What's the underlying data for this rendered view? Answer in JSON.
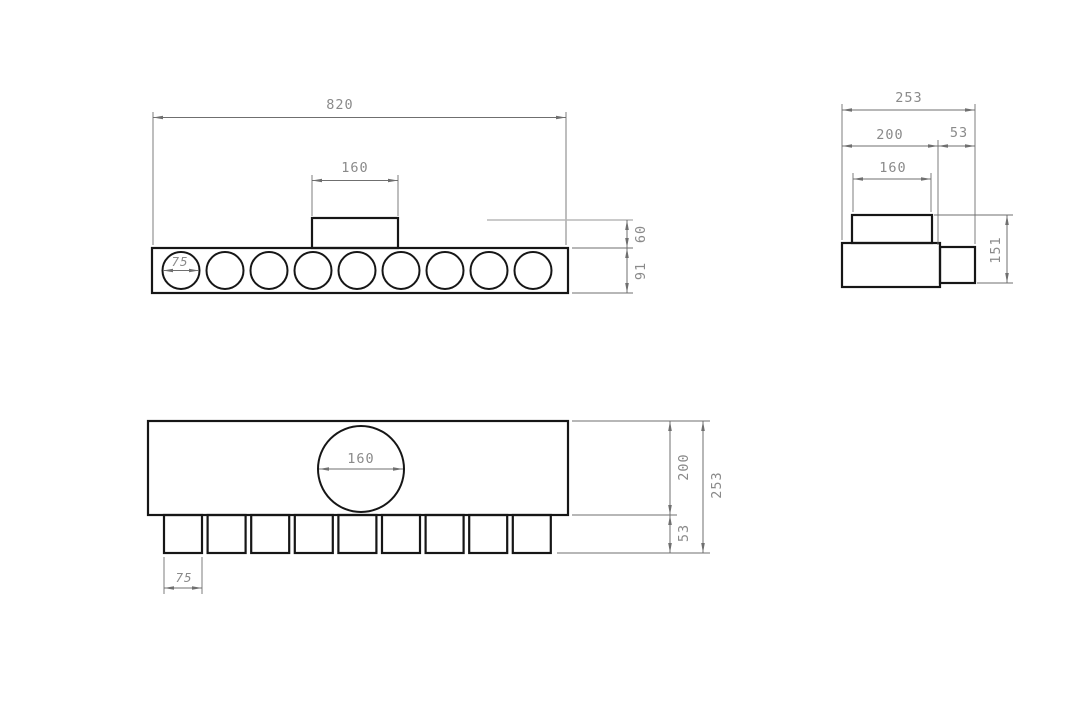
{
  "drawing": {
    "views": {
      "front": {
        "hole_count": 9,
        "labels": {
          "overall_width": "820",
          "port_width": "160",
          "hole_diameter": "75",
          "port_height": "60",
          "body_height": "91"
        }
      },
      "side": {
        "labels": {
          "overall_depth": "253",
          "body_depth": "200",
          "outlet_depth": "53",
          "port_width": "160",
          "overall_height": "151"
        }
      },
      "plan": {
        "tab_count": 9,
        "labels": {
          "port_diameter": "160",
          "tab_width": "75",
          "body_depth": "200",
          "tab_depth": "53",
          "overall_depth": "253"
        }
      }
    },
    "colors": {
      "background": "#ffffff",
      "object_line": "#161616",
      "dimension_line": "#6f6f6f",
      "dimension_text": "#8a8a8a",
      "projection_line": "#b8b8b8"
    }
  }
}
